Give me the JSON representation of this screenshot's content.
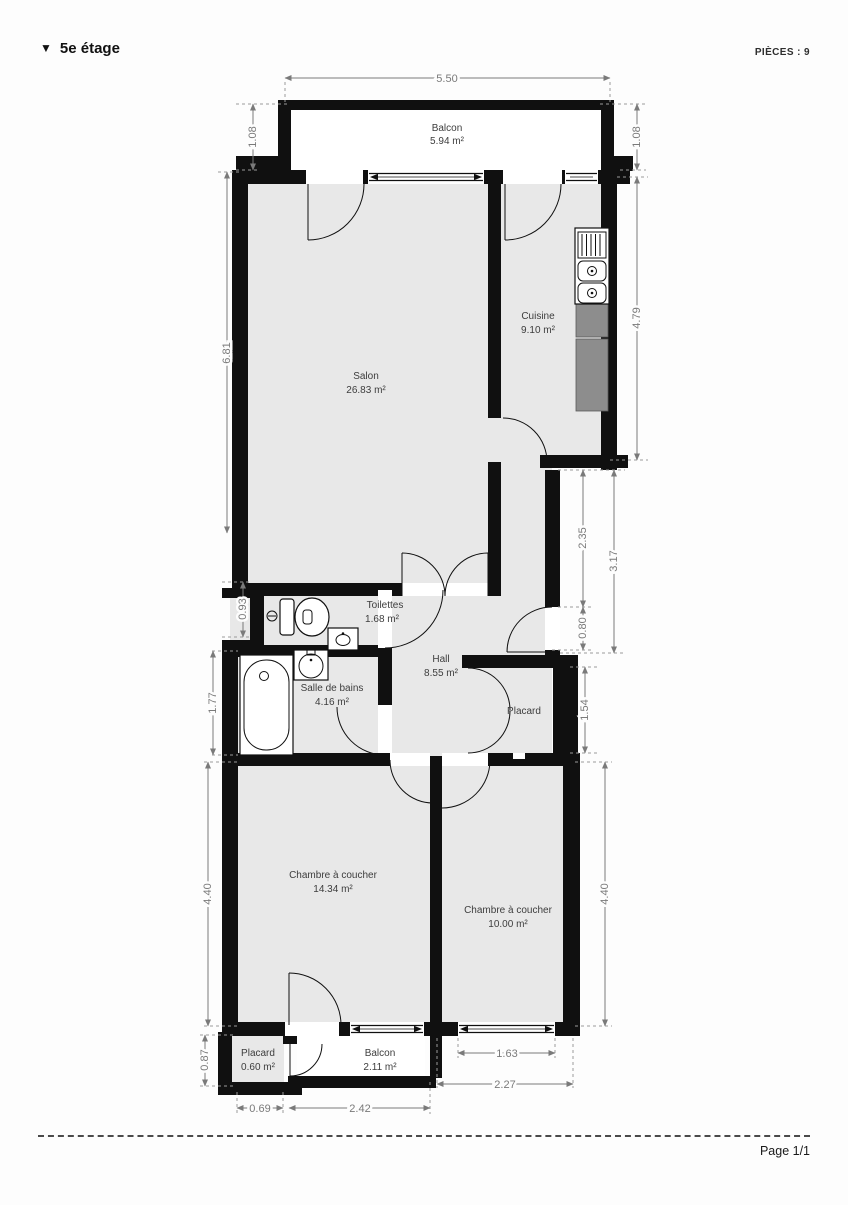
{
  "header": {
    "marker": "▼",
    "title": "5e étage",
    "pieces": "PIÈCES : 9"
  },
  "footer": {
    "page": "Page 1/1"
  },
  "colors": {
    "wall": "#101010",
    "room_fill": "#e8e8e8",
    "balcony_fill": "#ffffff",
    "counter": "#8d8d8d",
    "dimension": "#7a7a7a",
    "label": "#3d3d3d"
  },
  "plan": {
    "rooms": {
      "balcon_top": {
        "name": "Balcon",
        "area": "5.94 m²"
      },
      "salon": {
        "name": "Salon",
        "area": "26.83 m²"
      },
      "cuisine": {
        "name": "Cuisine",
        "area": "9.10 m²"
      },
      "toilettes": {
        "name": "Toilettes",
        "area": "1.68 m²"
      },
      "salle_de_bains": {
        "name": "Salle de bains",
        "area": "4.16 m²"
      },
      "hall": {
        "name": "Hall",
        "area": "8.55 m²"
      },
      "placard_hall": {
        "name": "Placard"
      },
      "chambre_1": {
        "name": "Chambre à coucher",
        "area": "14.34 m²"
      },
      "chambre_2": {
        "name": "Chambre à coucher",
        "area": "10.00 m²"
      },
      "placard_bas": {
        "name": "Placard",
        "area": "0.60 m²"
      },
      "balcon_bas": {
        "name": "Balcon",
        "area": "2.11 m²"
      }
    },
    "dims": {
      "width_top": "5.50",
      "balcony_left": "1.08",
      "balcony_right": "1.08",
      "salon_h": "6.81",
      "cuisine_h": "4.79",
      "corridor_h": "2.35",
      "corridor_total_h": "3.17",
      "entree_w": "0.80",
      "toilettes_h": "0.93",
      "bains_h": "1.77",
      "placard_h": "1.54",
      "chambre1_h": "4.40",
      "chambre2_h": "4.40",
      "placard_bas_h": "0.87",
      "placard_bas_w": "0.69",
      "balcon_bas_w": "2.42",
      "fenetre_w": "1.63",
      "chambre2_w": "2.27"
    }
  }
}
